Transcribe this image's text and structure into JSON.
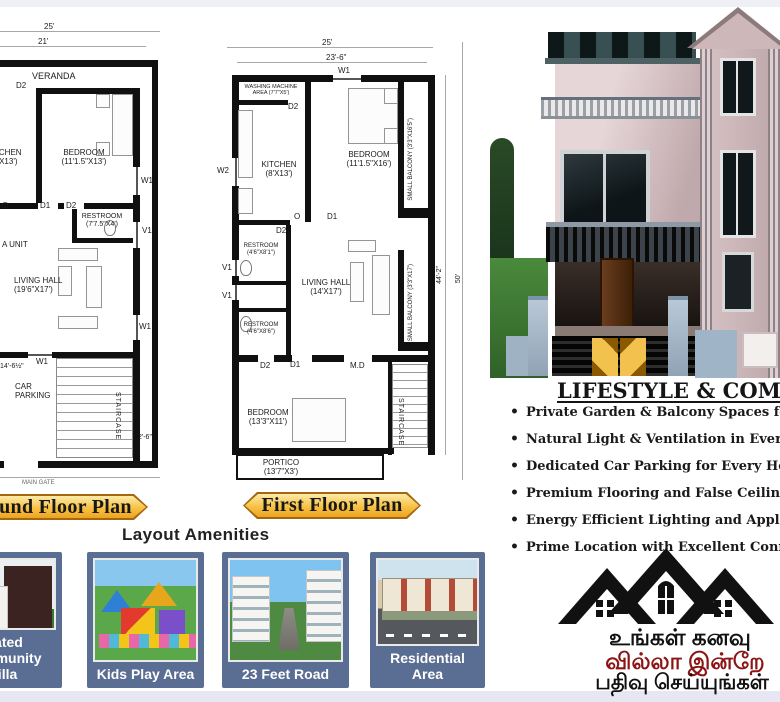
{
  "colors": {
    "banner_gold": "#f2b52e",
    "card_slate": "#5a6d93",
    "promo_maroon": "#8b1414",
    "logo_black": "#111111",
    "text_dark": "#1a1a1a"
  },
  "ground_plan": {
    "banner_label": "Ground Floor Plan",
    "dims": {
      "d25": "25'",
      "d21": "21'",
      "d146": "14'-6½\"",
      "d26": "2'-6\""
    },
    "rooms": {
      "veranda": "VERANDA",
      "kitchen": "KITCHEN (8'X13')",
      "bedroom": "BEDROOM (11'1.5\"X13')",
      "restroom": "RESTROOM (7'7.5\"X4')",
      "living": "LIVING HALL (19'6\"X17')",
      "parking": "CAR PARKING",
      "staircase": "STAIRCASE",
      "pooja_unit": "A UNIT",
      "o": "O",
      "main_gate": "MAIN GATE"
    },
    "m": {
      "d2a": "D2",
      "w1a": "W1",
      "d1": "D1",
      "d2b": "D2",
      "v1": "V1",
      "w1b": "W1",
      "w1c": "W1"
    }
  },
  "first_plan": {
    "banner_label": "First Floor Plan",
    "dims": {
      "d25": "25'",
      "d236": "23'-6\"",
      "d442": "44'-2\"",
      "d50": "50'"
    },
    "rooms": {
      "washing": "WASHING MACHINE AREA (7'7\"X5')",
      "kitchen": "KITCHEN (8'X13')",
      "bedroom": "BEDROOM (11'1.5\"X16')",
      "balcony1": "SMALL BALCONY (3'3\"X16'5\")",
      "restroom1": "RESTROOM (4'6\"X8'1\")",
      "restroom2": "RESTROOM (4'6\"X8'6\")",
      "living": "LIVING HALL (14'X17')",
      "balcony2": "SMALL BALCONY (3'3\"X17')",
      "bedroom2": "BEDROOM (13'3\"X11')",
      "portico": "PORTICO (13'7\"X3')",
      "staircase": "STAIRCASE"
    },
    "m": {
      "w1": "W1",
      "d2a": "D2",
      "w2": "W2",
      "o": "O",
      "d1a": "D1",
      "d2b": "D2",
      "v1a": "V1",
      "v1b": "V1",
      "d2c": "D2",
      "d1b": "D1",
      "md": "M.D"
    }
  },
  "amenities": {
    "heading": "Layout Amenities",
    "cards": [
      {
        "label": "Gated Community Villa"
      },
      {
        "label": "Kids Play Area"
      },
      {
        "label": "23 Feet Road"
      },
      {
        "label": "Residential Area"
      }
    ]
  },
  "lifestyle": {
    "heading": "LIFESTYLE & COMFORT",
    "bullets": [
      "Private Garden & Balcony Spaces for Every Villa",
      "Natural Light & Ventilation in Every Room",
      "Dedicated Car Parking for Every Home",
      "Premium Flooring and False Ceiling Interiors",
      "Energy Efficient Lighting and Appliances",
      "Prime Location with Excellent Connectivity"
    ]
  },
  "promo": {
    "line1": "உங்கள் கனவு",
    "line2": "வில்லா இன்றே",
    "line3": "பதிவு செய்யுங்கள்"
  }
}
